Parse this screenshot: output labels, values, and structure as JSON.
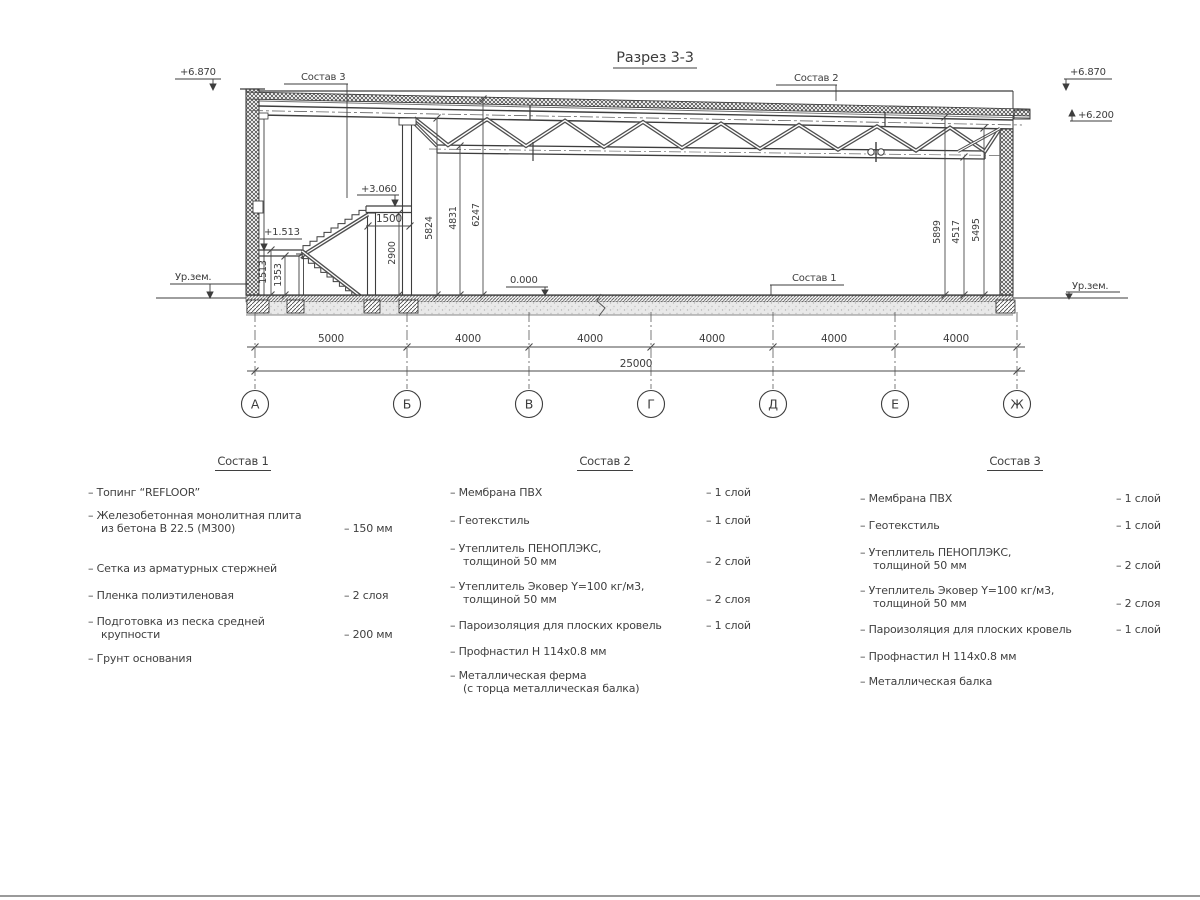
{
  "drawing": {
    "title": "Разрез 3-3",
    "leaders": {
      "sostav1": "Состав 1",
      "sostav2": "Состав 2",
      "sostav3": "Состав 3"
    },
    "elevations": {
      "top_left": "+6.870",
      "top_right": "+6.870",
      "roof_right": "+6.200",
      "platform": "+3.060",
      "landing": "+1.513",
      "floor": "0.000",
      "ground_left": "Ур.зем.",
      "ground_right": "Ур.зем."
    },
    "vertical_dims": {
      "d1513": "1513",
      "d1353": "1353",
      "d2900": "2900",
      "d1500": "1500",
      "d5824": "5824",
      "d4831": "4831",
      "d6247": "6247",
      "d5899": "5899",
      "d4517": "4517",
      "d5495": "5495"
    },
    "span_dims": [
      "5000",
      "4000",
      "4000",
      "4000",
      "4000",
      "4000"
    ],
    "total_dim": "25000",
    "axes": [
      "А",
      "Б",
      "В",
      "Г",
      "Д",
      "Е",
      "Ж"
    ]
  },
  "compositions": [
    {
      "title": "Состав 1",
      "items": [
        {
          "name": "– Топинг “REFLOOR”",
          "qty": ""
        },
        {
          "name": "– Железобетонная  монолитная плита\nиз бетона В 22.5 (М300)",
          "qty": "– 150 мм"
        },
        {
          "name": "– Сетка из арматурных стержней",
          "qty": ""
        },
        {
          "name": "– Пленка полиэтиленовая",
          "qty": "– 2 слоя"
        },
        {
          "name": "– Подготовка из песка средней\nкрупности",
          "qty": "– 200 мм"
        },
        {
          "name": "– Грунт основания",
          "qty": ""
        }
      ]
    },
    {
      "title": "Состав 2",
      "items": [
        {
          "name": "– Мембрана ПВХ",
          "qty": "– 1 слой"
        },
        {
          "name": "– Геотекстиль",
          "qty": "– 1 слой"
        },
        {
          "name": "– Утеплитель ПЕНОПЛЭКС,\nтолщиной 50 мм",
          "qty": "– 2 слой"
        },
        {
          "name": "– Утеплитель Эковер Y=100 кг/м3,\nтолщиной 50 мм",
          "qty": "– 2 слоя"
        },
        {
          "name": "– Пароизоляция для плоских кровель",
          "qty": "– 1 слой"
        },
        {
          "name": "– Профнастил Н 114х0.8 мм",
          "qty": ""
        },
        {
          "name": "– Металлическая ферма\n(с торца металлическая балка)",
          "qty": ""
        }
      ]
    },
    {
      "title": "Состав 3",
      "items": [
        {
          "name": "– Мембрана ПВХ",
          "qty": "– 1 слой"
        },
        {
          "name": "– Геотекстиль",
          "qty": "– 1 слой"
        },
        {
          "name": "– Утеплитель ПЕНОПЛЭКС,\nтолщиной 50 мм",
          "qty": "– 2 слой"
        },
        {
          "name": "– Утеплитель Эковер Y=100 кг/м3,\nтолщиной 50 мм",
          "qty": "– 2 слоя"
        },
        {
          "name": "– Пароизоляция для плоских кровель",
          "qty": "– 1 слой"
        },
        {
          "name": "– Профнастил Н 114х0.8 мм",
          "qty": ""
        },
        {
          "name": "– Металлическая балка",
          "qty": ""
        }
      ]
    }
  ]
}
